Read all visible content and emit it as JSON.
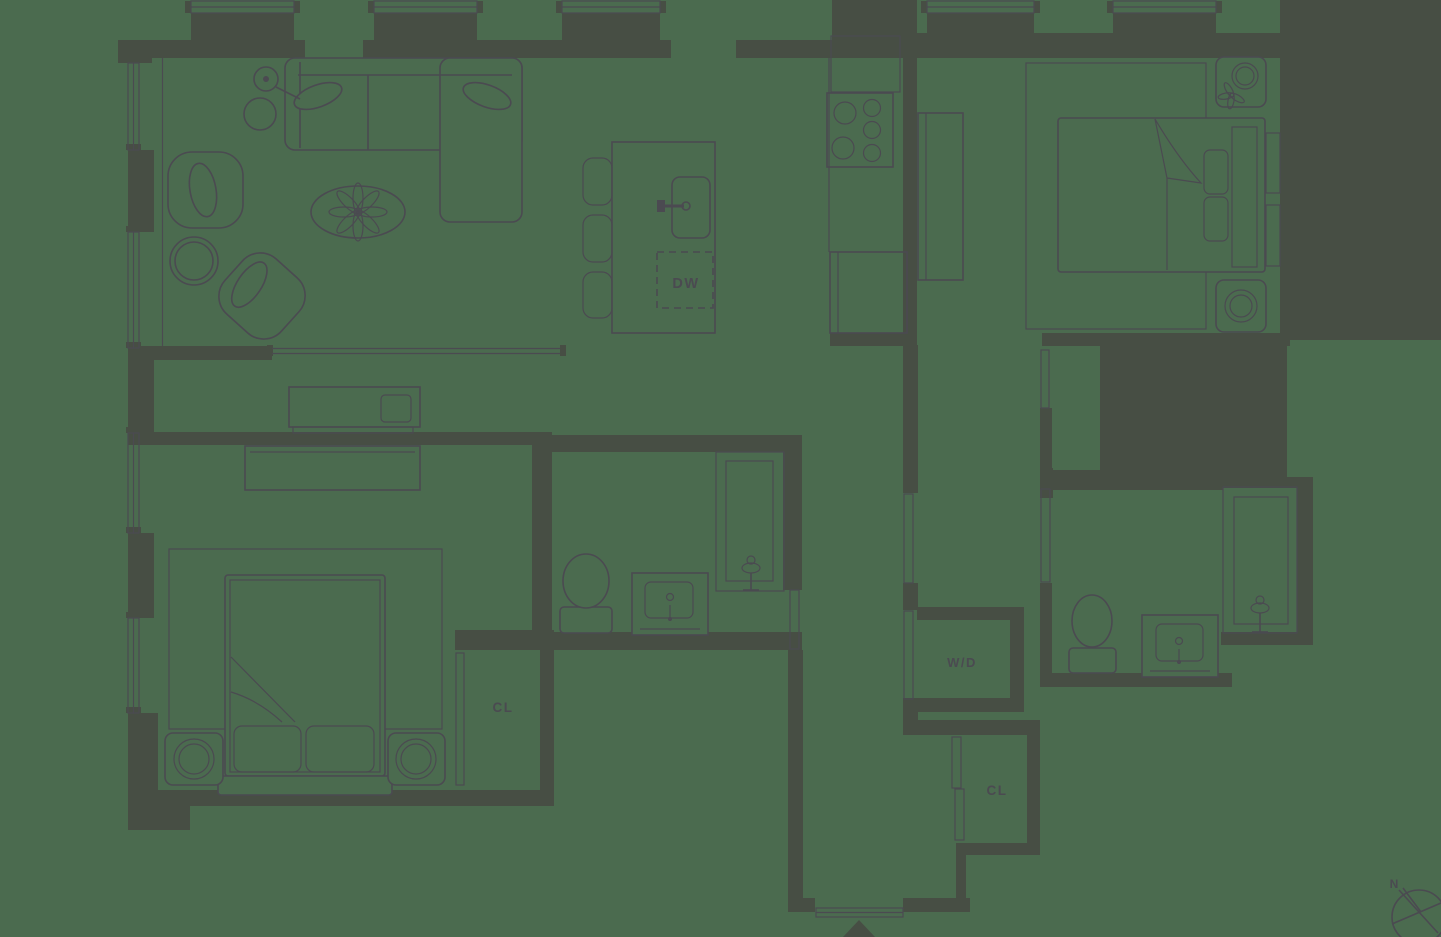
{
  "floorplan": {
    "labels": {
      "dishwasher": "DW",
      "washer_dryer": "W/D",
      "bedroom_closet": "CL",
      "entry_closet": "CL",
      "compass_north": "N"
    },
    "colors": {
      "background": "#4b6b4f",
      "wall_fill": "#474e44",
      "line": "#4b4a51"
    }
  }
}
